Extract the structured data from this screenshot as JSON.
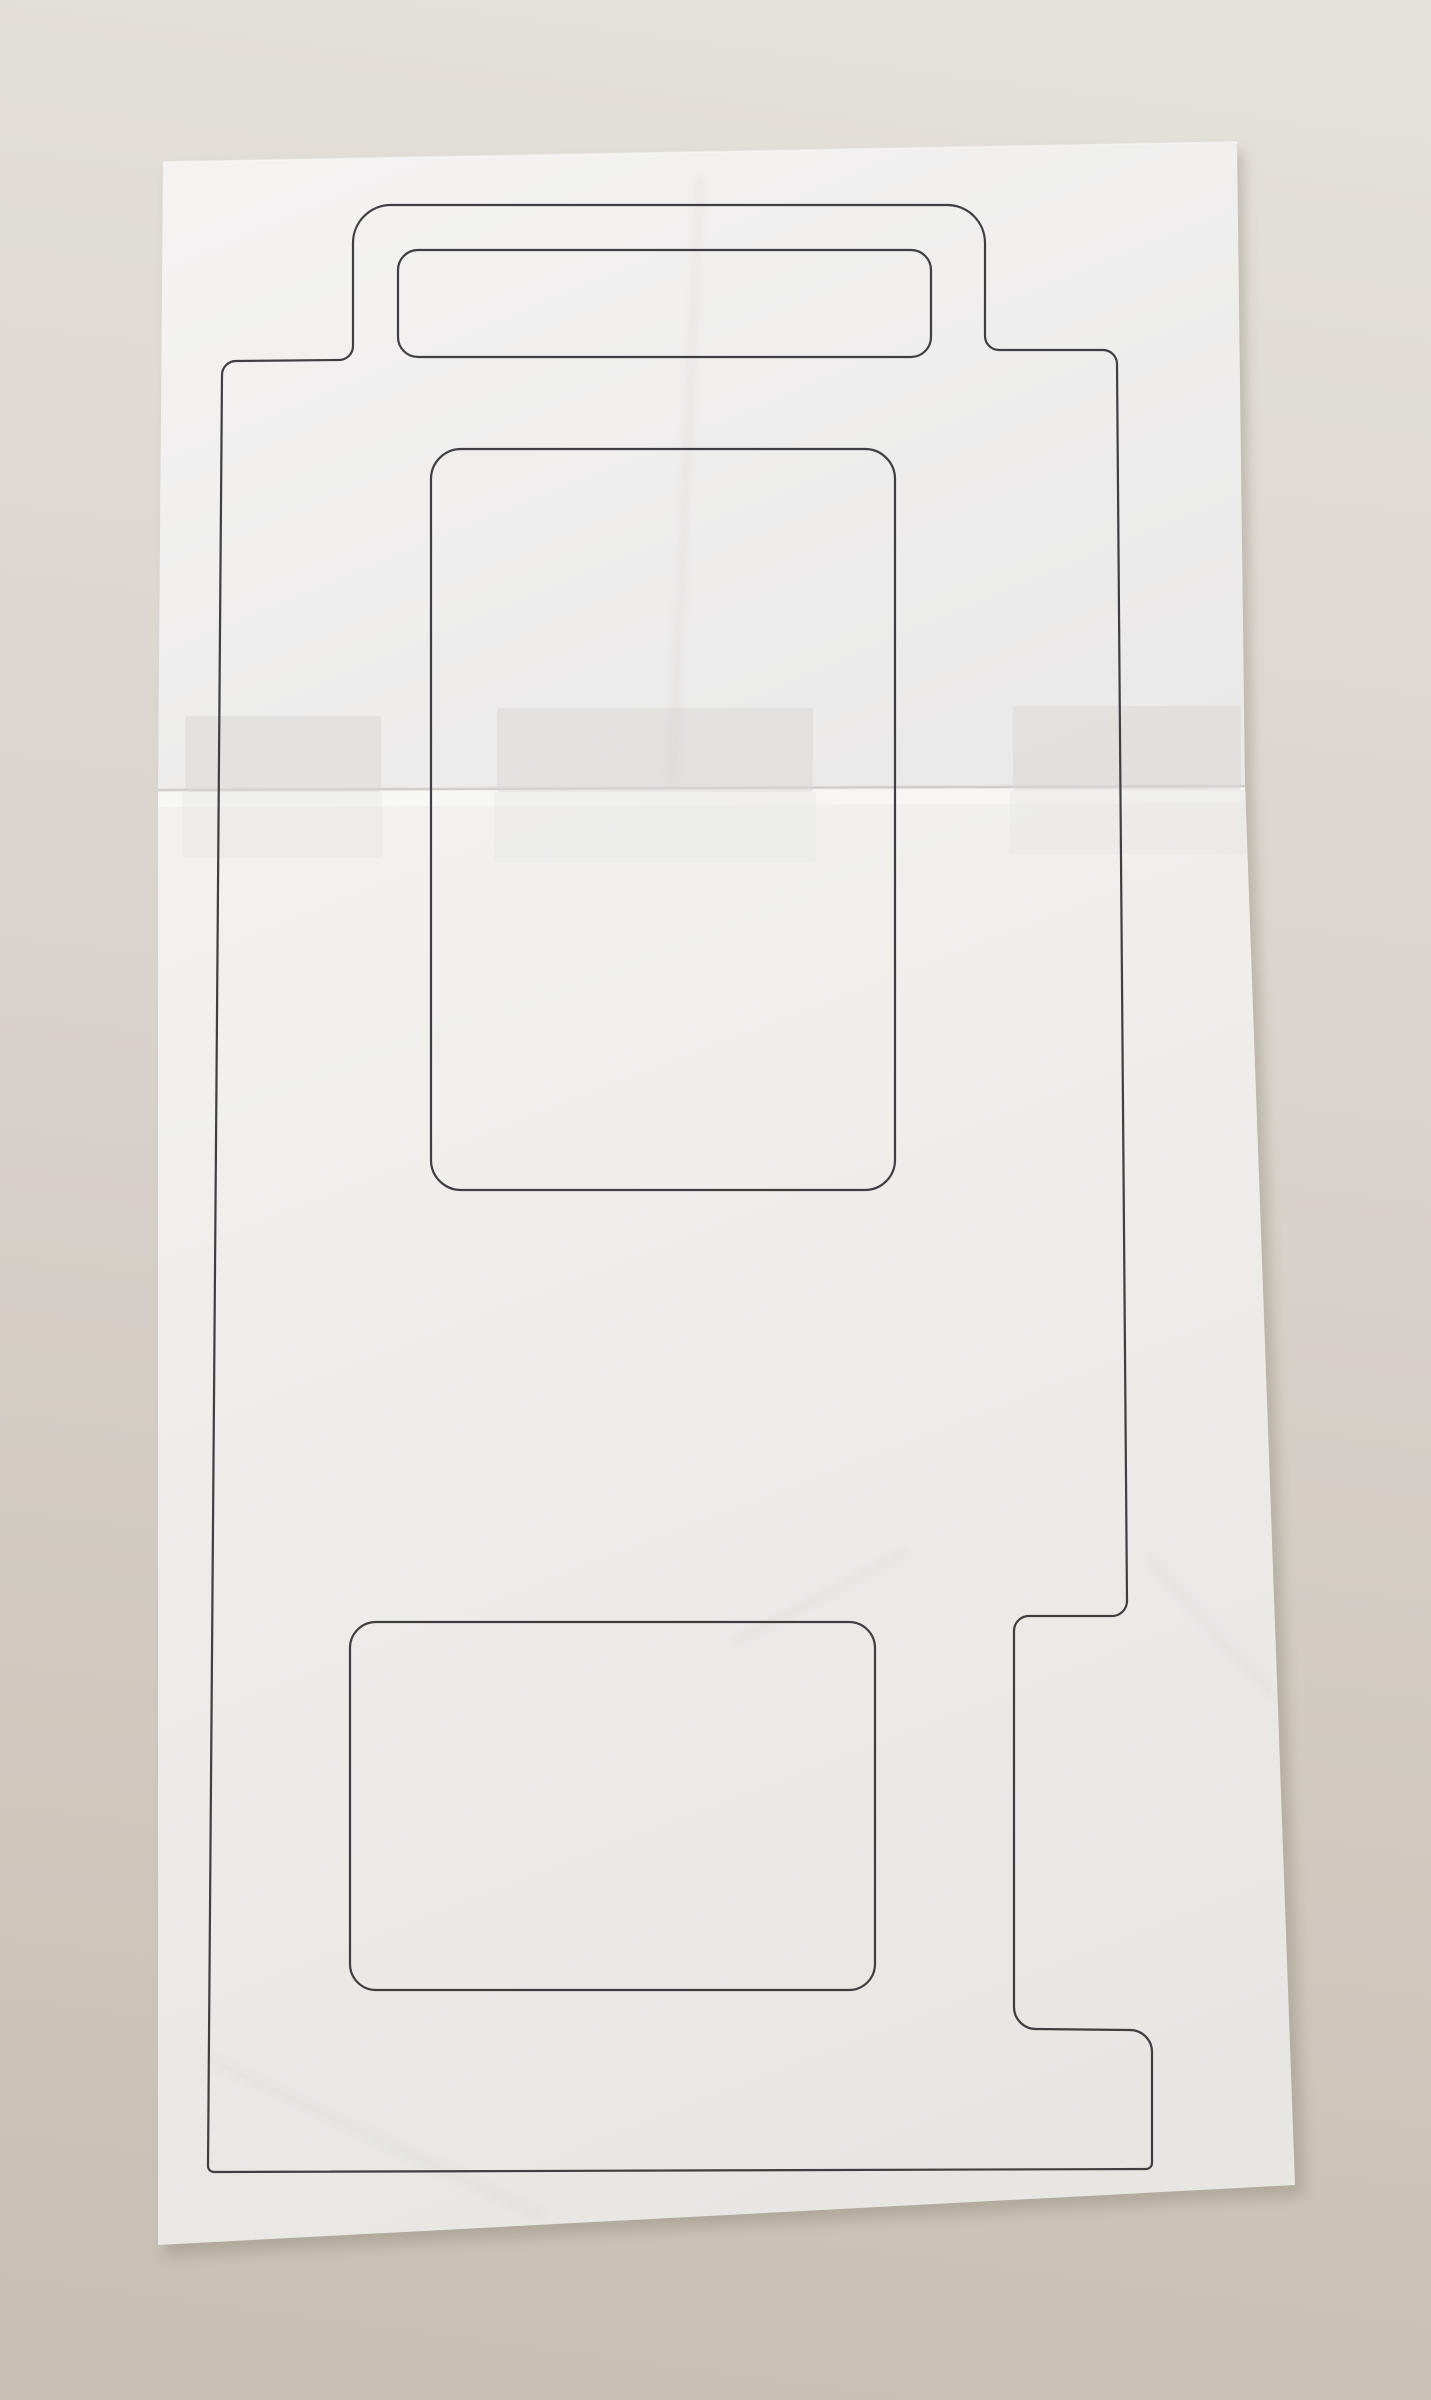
{
  "colors": {
    "bg_top": "#e4e0da",
    "bg_mid": "#d8d3cb",
    "bg_bottom": "#c7c0b4",
    "drop_shadow": "#8f8574",
    "paper_top_light": "#f4f3f2",
    "paper_top_dark": "#eae9e9",
    "paper_bottom_light": "#f2f1ef",
    "paper_bottom_dark": "#e8e6e3",
    "paper_edge_highlight": "#fdfdfc",
    "seam_line": "#c6c3bf",
    "seam_highlight": "#fbfbfa",
    "tape_above": "#d9d7d4",
    "tape_below": "#e6e4e1",
    "crease": "#b3afa9",
    "outline_stroke": "#3f3e42"
  },
  "paper": {
    "shadow_points": "170,172 1243,152 1252,786 1305,2196 164,2256",
    "top_sheet_points": "163,162 1237,142 1245,784 158,788",
    "bottom_sheet_points": "158,788 1245,784 1295,2185 158,2245",
    "seam": {
      "x1": 158,
      "y1": 790,
      "x2": 1245,
      "y2": 786
    },
    "seam_highlight_points": "158,792 1245,788 1245,803 158,807"
  },
  "template_outline": {
    "outer_path": "M 391 205 L 947 205 A 38 38 0 0 1 985 243 L 985 336 A 14 14 0 0 0 999 350 L 1103 350 A 14 14 0 0 1 1117 364 L 1127 1601 A 15 15 0 0 1 1112 1616 L 1029 1616 A 15 15 0 0 0 1014 1631 L 1014 2007 A 22 22 0 0 0 1036 2029 L 1130 2030 A 22 22 0 0 1 1152 2052 L 1152 2163 A 6 6 0 0 1 1146 2169 L 214 2172 A 6 6 0 0 1 208 2166 L 222 375 A 14 14 0 0 1 236 361 L 339 360 A 14 14 0 0 0 353 346 L 353 243 A 38 38 0 0 1 391 205 Z",
    "tab_label_rect": {
      "x": 398,
      "y": 250,
      "width": 533,
      "height": 107,
      "rx": 20
    },
    "window_rect": {
      "x": 431,
      "y": 449,
      "width": 464,
      "height": 741,
      "rx": 30
    },
    "square_rect": {
      "x": 350,
      "y": 1622,
      "width": 525,
      "height": 368,
      "rx": 26
    }
  },
  "tape_pieces": [
    {
      "x": 185,
      "y": 716,
      "width": 196,
      "height": 76
    },
    {
      "x": 497,
      "y": 708,
      "width": 316,
      "height": 84
    },
    {
      "x": 1013,
      "y": 706,
      "width": 228,
      "height": 84
    },
    {
      "x": 182,
      "y": 792,
      "width": 200,
      "height": 66
    },
    {
      "x": 494,
      "y": 792,
      "width": 322,
      "height": 70
    },
    {
      "x": 1010,
      "y": 790,
      "width": 236,
      "height": 64
    }
  ],
  "creases": [
    {
      "d": "M 700 180 L 672 778"
    },
    {
      "d": "M 1150 1560 L 1272 1695"
    },
    {
      "d": "M 210 2060 L 540 2215"
    },
    {
      "d": "M 735 1642 L 905 1552"
    }
  ]
}
